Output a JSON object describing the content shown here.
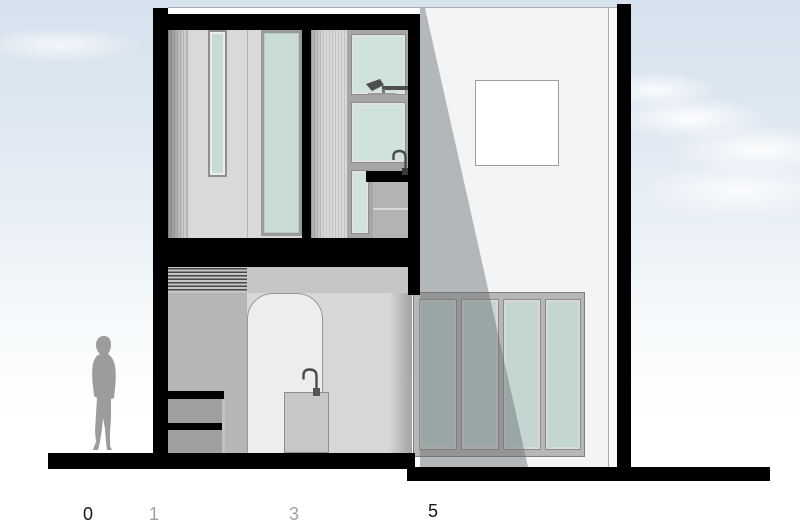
{
  "drawing": {
    "kind": "building cross-section and elevation",
    "scale_figure": "standing-person-silhouette"
  },
  "scale_bar": {
    "marks": [
      {
        "label": "0",
        "color": "#161616"
      },
      {
        "label": "1",
        "color": "#a2a2a2"
      },
      {
        "label": "3",
        "color": "#a2a2a2"
      },
      {
        "label": "5",
        "color": "#161616"
      }
    ]
  },
  "colors": {
    "structure_black": "#000000",
    "sky_top": "#d6e2ee",
    "glass_teal": "#c9dcd8",
    "glazing_teal": "#c3d6d2",
    "facade_offwhite": "#f3f4f6",
    "shadow_gray": "rgba(104,108,112,0.45)",
    "interior_wall_light": "#d9d9d9",
    "interior_wall_medium": "#b6b6b6",
    "arch_interior": "#ededed",
    "cabinet_gray": "#9f9f9f",
    "figure_gray": "#9c9c9c"
  }
}
